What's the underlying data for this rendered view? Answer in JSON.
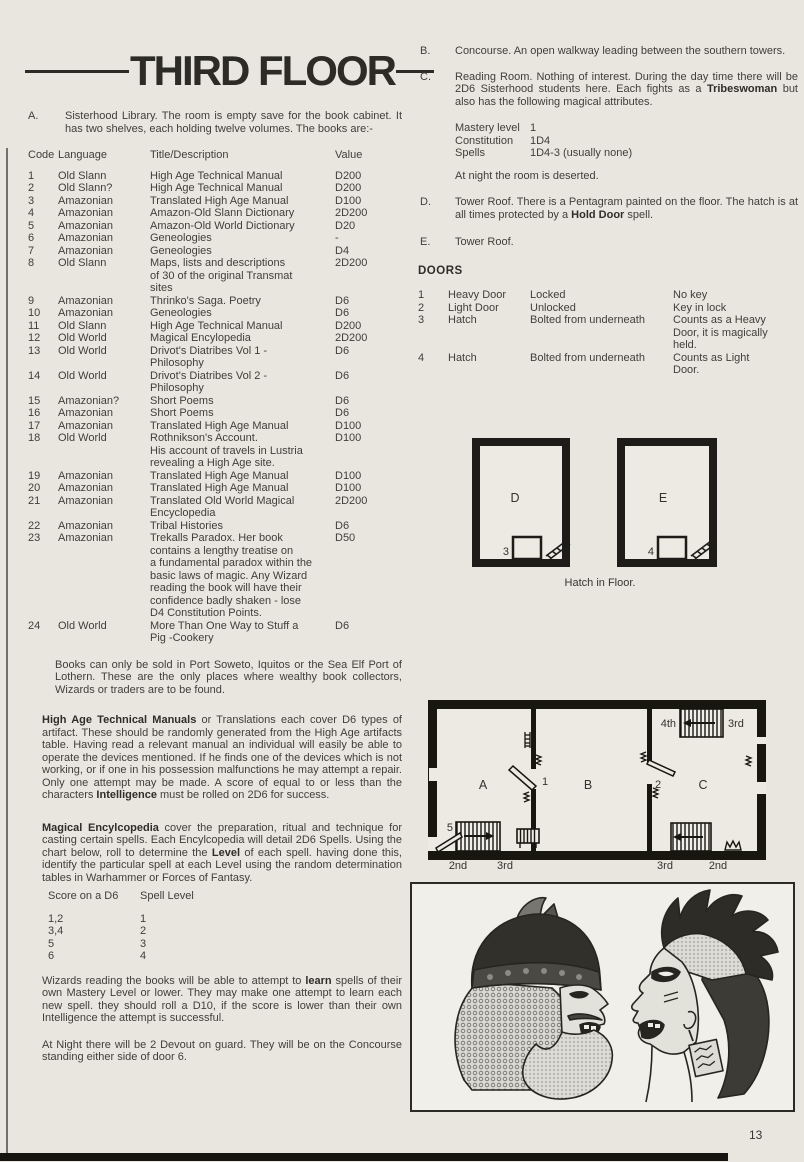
{
  "page": {
    "title": "THIRD FLOOR",
    "page_number": "13"
  },
  "left": {
    "section_a": {
      "label": "A.",
      "text": "Sisterhood Library. The room is empty save for the book cabinet. It has two shelves, each holding twelve volumes. The books are:-"
    },
    "book_table": {
      "headers": {
        "code": "Code",
        "language": "Language",
        "title": "Title/Description",
        "value": "Value"
      },
      "rows": [
        {
          "code": "1",
          "language": "Old Slann",
          "title": "High Age Technical Manual",
          "value": "D200"
        },
        {
          "code": "2",
          "language": "Old Slann?",
          "title": "High Age Technical Manual",
          "value": "D200"
        },
        {
          "code": "3",
          "language": "Amazonian",
          "title": "Translated High Age Manual",
          "value": "D100"
        },
        {
          "code": "4",
          "language": "Amazonian",
          "title": "Amazon-Old Slann Dictionary",
          "value": "2D200"
        },
        {
          "code": "5",
          "language": "Amazonian",
          "title": "Amazon-Old World Dictionary",
          "value": "D20"
        },
        {
          "code": "6",
          "language": "Amazonian",
          "title": "Geneologies",
          "value": "-"
        },
        {
          "code": "7",
          "language": "Amazonian",
          "title": "Geneologies",
          "value": "D4"
        },
        {
          "code": "8",
          "language": "Old Slann",
          "title": "Maps, lists and descriptions\nof 30 of the original Transmat\nsites",
          "value": "2D200"
        },
        {
          "code": "9",
          "language": "Amazonian",
          "title": "Thrinko's Saga. Poetry",
          "value": "D6"
        },
        {
          "code": "10",
          "language": "Amazonian",
          "title": "Geneologies",
          "value": "D6"
        },
        {
          "code": "11",
          "language": "Old Slann",
          "title": "High Age Technical Manual",
          "value": "D200"
        },
        {
          "code": "12",
          "language": "Old World",
          "title": "Magical Encylopedia",
          "value": "2D200"
        },
        {
          "code": "13",
          "language": "Old World",
          "title": "Drivot's Diatribes Vol 1 -\nPhilosophy",
          "value": "D6"
        },
        {
          "code": "14",
          "language": "Old World",
          "title": "Drivot's Diatribes Vol 2 -\nPhilosophy",
          "value": "D6"
        },
        {
          "code": "15",
          "language": "Amazonian?",
          "title": "Short Poems",
          "value": "D6"
        },
        {
          "code": "16",
          "language": "Amazonian",
          "title": "Short Poems",
          "value": "D6"
        },
        {
          "code": "17",
          "language": "Amazonian",
          "title": "Translated High Age Manual",
          "value": "D100"
        },
        {
          "code": "18",
          "language": "Old World",
          "title": "Rothnikson's Account.\nHis account of travels in Lustria\nrevealing a High Age site.",
          "value": "D100"
        },
        {
          "code": "19",
          "language": "Amazonian",
          "title": "Translated High Age Manual",
          "value": "D100"
        },
        {
          "code": "20",
          "language": "Amazonian",
          "title": "Translated High Age Manual",
          "value": "D100"
        },
        {
          "code": "21",
          "language": "Amazonian",
          "title": "Translated Old World Magical\nEncyclopedia",
          "value": "2D200"
        },
        {
          "code": "22",
          "language": "Amazonian",
          "title": "Tribal Histories",
          "value": "D6"
        },
        {
          "code": "23",
          "language": "Amazonian",
          "title": "Trekalls Paradox. Her book\ncontains a lengthy treatise on\na fundamental paradox within the\nbasic laws of magic. Any Wizard\nreading the book will have their\nconfidence badly shaken - lose\nD4 Constitution Points.",
          "value": "D50"
        },
        {
          "code": "24",
          "language": "Old World",
          "title": "More Than One Way to Stuff a\nPig -Cookery",
          "value": "D6"
        }
      ]
    },
    "para_sold": "Books can only be sold in Port Soweto, Iquitos or the Sea Elf Port of Lothern. These are the only places where wealthy book collectors, Wizards or traders are to be found.",
    "para_manuals": {
      "bold1": "High Age Technical Manuals",
      "text1": " or Translations each cover D6 types of artifact.  These should be randomly generated from the High Age artifacts table.  Having read a relevant manual an individual will easily be able to operate the devices mentioned.  If he finds one of the devices which is not working, or if one in his possession malfunctions he may attempt a repair. Only one attempt may be made. A score of equal to or less than the characters ",
      "bold2": "Intelligence",
      "text2": " must be rolled on 2D6 for success."
    },
    "para_encyclopedia": {
      "bold1": "Magical Encylcopedia",
      "text1": " cover the preparation, ritual and technique for casting certain spells. Each Encylcopedia will detail 2D6 Spells. Using the chart below, roll to determine the ",
      "bold2": "Level",
      "text2": " of each spell. having done this, identify the particular spell at each Level using the random determination tables in Warhammer or Forces of Fantasy."
    },
    "spell_table": {
      "col1_header": "Score on a D6",
      "col2_header": "Spell Level",
      "rows": [
        {
          "score": "1,2",
          "level": "1"
        },
        {
          "score": "3,4",
          "level": "2"
        },
        {
          "score": "5",
          "level": "3"
        },
        {
          "score": "6",
          "level": "4"
        }
      ]
    },
    "para_wizards": {
      "text1": "Wizards reading the books will be able to attempt to ",
      "bold1": "learn",
      "text2": " spells of their own Mastery Level or lower. They may make one attempt to learn each new spell.  they should roll a D10, if the score is lower than their own Intelligence the attempt is successful."
    },
    "para_night": "At Night there will be 2 Devout on guard. They will be on the Concourse standing either side of door 6."
  },
  "right": {
    "section_b": {
      "label": "B.",
      "text": "Concourse. An open walkway leading between the southern towers."
    },
    "section_c": {
      "label": "C.",
      "text1": "Reading Room. Nothing of interest. During the day time there will be 2D6 Sisterhood students here. Each fights as a ",
      "bold1": "Tribeswoman",
      "text2": " but also has the following magical attributes.",
      "stats": [
        {
          "name": "Mastery level",
          "value": "1"
        },
        {
          "name": "Constitution",
          "value": "1D4"
        },
        {
          "name": "Spells",
          "value": "1D4-3 (usually none)"
        }
      ],
      "night": "At night the room is deserted."
    },
    "section_d": {
      "label": "D.",
      "text1": "Tower Roof. There is a Pentagram painted on the floor. The hatch is at all times protected by a ",
      "bold1": "Hold Door",
      "text2": " spell."
    },
    "section_e": {
      "label": "E.",
      "text": "Tower Roof."
    },
    "doors": {
      "heading": "DOORS",
      "rows": [
        {
          "num": "1",
          "type": "Heavy Door",
          "state": "Locked",
          "note": "No key"
        },
        {
          "num": "2",
          "type": "Light Door",
          "state": "Unlocked",
          "note": "Key in lock"
        },
        {
          "num": "3",
          "type": "Hatch",
          "state": "Bolted from underneath",
          "note": "Counts as a Heavy\nDoor, it is magically\nheld."
        },
        {
          "num": "4",
          "type": "Hatch",
          "state": "Bolted from underneath",
          "note": "Counts as Light\nDoor."
        }
      ]
    },
    "roof_diagram": {
      "room_d_label": "D",
      "room_d_hatch_num": "3",
      "room_e_label": "E",
      "room_e_hatch_num": "4",
      "caption": "Hatch in Floor."
    },
    "floor_plan": {
      "room_a": "A",
      "room_b": "B",
      "room_c": "C",
      "door_1": "1",
      "door_2": "2",
      "stair_5": "5",
      "top_stairs_left_label": "4th",
      "top_stairs_right_label": "3rd",
      "bottom_left_label_1": "2nd",
      "bottom_left_label_2": "3rd",
      "bottom_right_label_1": "3rd",
      "bottom_right_label_2": "2nd"
    }
  }
}
